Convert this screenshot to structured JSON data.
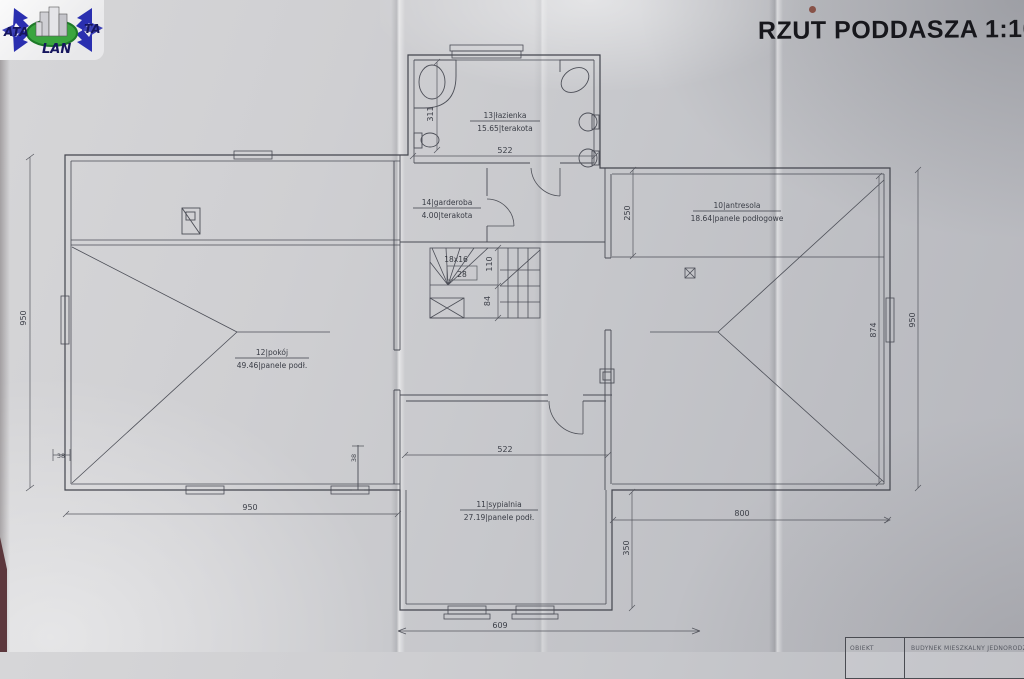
{
  "logo": {
    "text_left": "ATA",
    "text_right": "TA",
    "text_bottom": "LAN"
  },
  "header": {
    "title": "RZUT PODDASZA 1:100"
  },
  "rooms": {
    "bathroom": {
      "name_line": "13|łazienka",
      "area_line": "15.65|terakota"
    },
    "wardrobe": {
      "name_line": "14|garderoba",
      "area_line": "4.00|terakota"
    },
    "mezzanine": {
      "name_line": "10|antresola",
      "area_line": "18.64|panele podłogowe"
    },
    "room": {
      "name_line": "12|pokój",
      "area_line": "49.46|panele podł."
    },
    "bedroom": {
      "name_line": "11|sypialnia",
      "area_line": "27.19|panele podł."
    }
  },
  "stairs": {
    "format": "18x16",
    "count": "28"
  },
  "dims": {
    "left_height": "950",
    "left_width": "950",
    "right_width": "800",
    "bedroom_width_bottom": "609",
    "bathroom_width": "522",
    "bedroom_width": "522",
    "bathroom_height": "311",
    "mezzanine_top": "250",
    "bedroom_side": "350",
    "mezzanine_inner_height": "874",
    "right_height": "950",
    "stairs_upper": "110",
    "stairs_lower": "84",
    "wall_left": "38",
    "wall_mid": "38"
  },
  "title_block": {
    "label": "OBIEKT",
    "value": "BUDYNEK MIESZKALNY JEDNORODZINNY"
  }
}
